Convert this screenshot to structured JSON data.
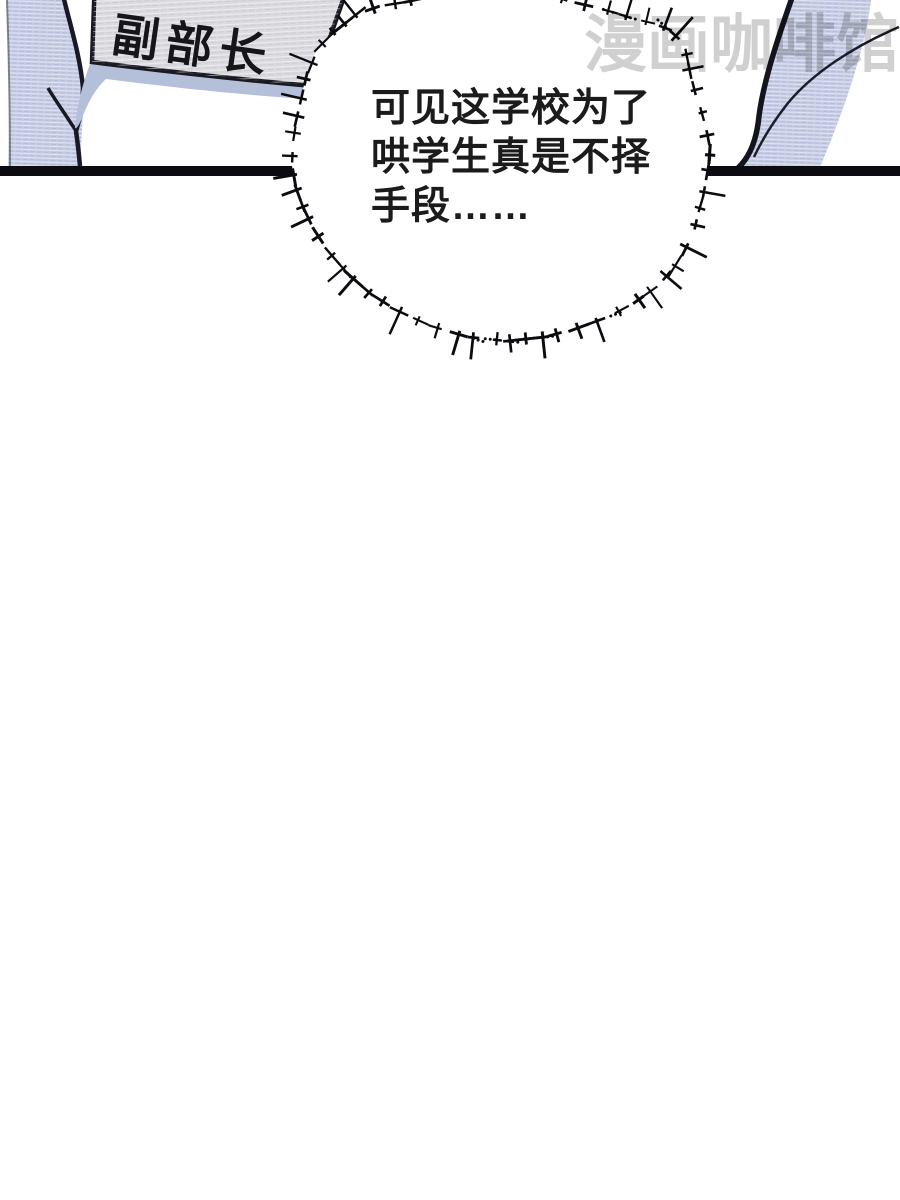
{
  "badge": {
    "label": "副部长"
  },
  "bubble": {
    "lines": [
      "可见这学校为了",
      "哄学生真是不择",
      "手段……"
    ]
  },
  "watermark": {
    "text": "漫画咖啡馆"
  },
  "colors": {
    "sleeve": "#c6cce4",
    "sleeve_shade": "#b4bfda",
    "sign": "#dbdbdf",
    "ink": "#0b0b10",
    "bubble_fill": "#ffffff",
    "watermark": "#cbcbcb"
  }
}
